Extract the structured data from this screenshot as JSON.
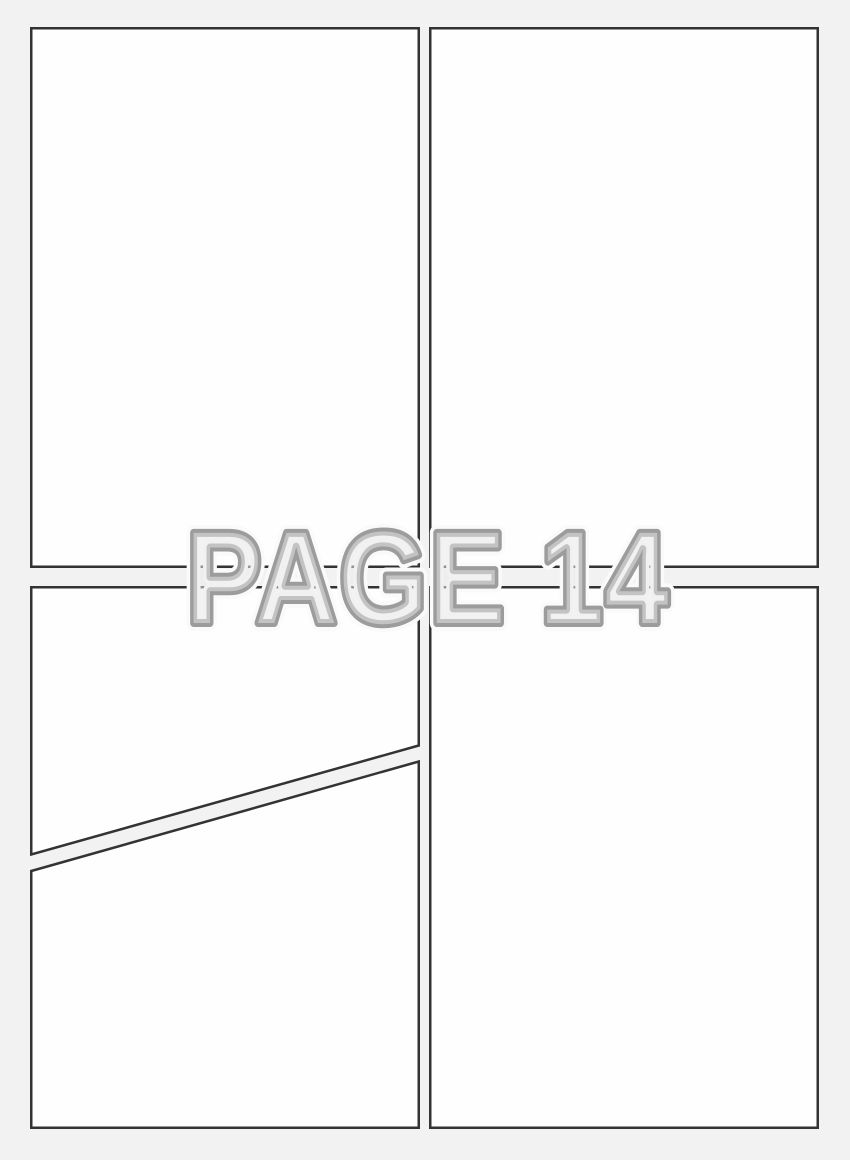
{
  "watermark": {
    "text": "PAGE 14"
  },
  "colors": {
    "background": "#f2f2f2",
    "panel_fill": "#fefefe",
    "panel_border": "#333333",
    "watermark_fill": "#e8e8e8",
    "watermark_outline": "#9c9c9c",
    "watermark_halo": "#fafafa"
  },
  "panels": [
    {
      "id": "top-left"
    },
    {
      "id": "top-right"
    },
    {
      "id": "bottom-left-upper"
    },
    {
      "id": "bottom-left-lower"
    },
    {
      "id": "bottom-right"
    }
  ]
}
